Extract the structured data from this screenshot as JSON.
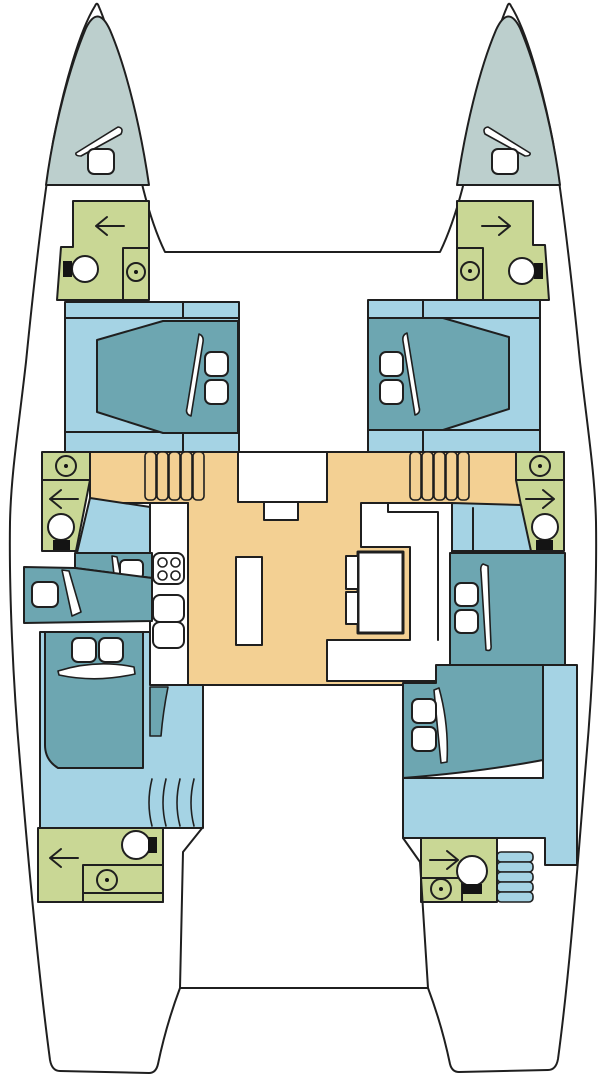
{
  "palette": {
    "hull_white": "#ffffff",
    "outline": "#1f1f1f",
    "foredeck_gray": "#bccfcd",
    "bathroom_green": "#c9d795",
    "floor_blue": "#a5d3e4",
    "bed_teal": "#6da6b1",
    "salon_orange": "#f3d093",
    "fixture_black": "#141414"
  },
  "diagram": {
    "type": "catamaran-floor-plan",
    "orientation": "bow-up",
    "zones": [
      {
        "id": "foredeck-port",
        "color_key": "foredeck_gray",
        "icons": [
          "deck-hatch-icon",
          "sail-sliver-icon"
        ]
      },
      {
        "id": "foredeck-starboard",
        "color_key": "foredeck_gray",
        "icons": [
          "deck-hatch-icon",
          "sail-sliver-icon"
        ]
      },
      {
        "id": "bow-head-port",
        "color_key": "bathroom_green",
        "icons": [
          "door-arrow-left-icon",
          "toilet-icon",
          "sink-icon"
        ]
      },
      {
        "id": "bow-head-starboard",
        "color_key": "bathroom_green",
        "icons": [
          "door-arrow-right-icon",
          "toilet-icon",
          "sink-icon"
        ]
      },
      {
        "id": "forward-cabin-port",
        "color_key": "floor_blue",
        "icons": [
          "double-berth-icon",
          "pillow-icon",
          "pillow-icon"
        ]
      },
      {
        "id": "forward-cabin-starboard",
        "color_key": "floor_blue",
        "icons": [
          "double-berth-icon",
          "pillow-icon",
          "pillow-icon"
        ]
      },
      {
        "id": "mid-head-port",
        "color_key": "bathroom_green",
        "icons": [
          "sink-icon",
          "door-arrow-left-icon",
          "toilet-icon"
        ]
      },
      {
        "id": "mid-head-starboard",
        "color_key": "bathroom_green",
        "icons": [
          "sink-icon",
          "door-arrow-right-icon",
          "toilet-icon"
        ]
      },
      {
        "id": "salon",
        "color_key": "salon_orange",
        "icons": [
          "companionway-steps-icon",
          "companionway-steps-icon",
          "stove-icon",
          "galley-sinks-icon",
          "island-icon",
          "dinette-table-icon"
        ]
      },
      {
        "id": "mid-cabin-port",
        "color_key": "bed_teal",
        "icons": [
          "single-berth-icon",
          "single-berth-icon",
          "pillow-icon",
          "pillow-icon"
        ]
      },
      {
        "id": "mid-cabin-starboard",
        "color_key": "bed_teal",
        "icons": [
          "double-berth-icon",
          "pillow-icon",
          "pillow-icon"
        ]
      },
      {
        "id": "aft-cabin-port",
        "color_key": "bed_teal",
        "icons": [
          "double-berth-icon",
          "pillow-icon",
          "pillow-icon",
          "stairs-curved-icon"
        ]
      },
      {
        "id": "aft-cabin-starboard",
        "color_key": "bed_teal",
        "icons": [
          "double-berth-icon",
          "pillow-icon",
          "pillow-icon",
          "stairs-bars-icon"
        ]
      },
      {
        "id": "aft-head-port",
        "color_key": "bathroom_green",
        "icons": [
          "door-arrow-left-icon",
          "toilet-icon",
          "sink-icon"
        ]
      },
      {
        "id": "aft-head-starboard",
        "color_key": "bathroom_green",
        "icons": [
          "door-arrow-right-icon",
          "toilet-icon",
          "sink-icon"
        ]
      }
    ],
    "counts": {
      "cabins": 6,
      "heads": 6,
      "toilets": 6,
      "sinks": 6,
      "deck_hatches": 2,
      "stoves": 1
    }
  }
}
